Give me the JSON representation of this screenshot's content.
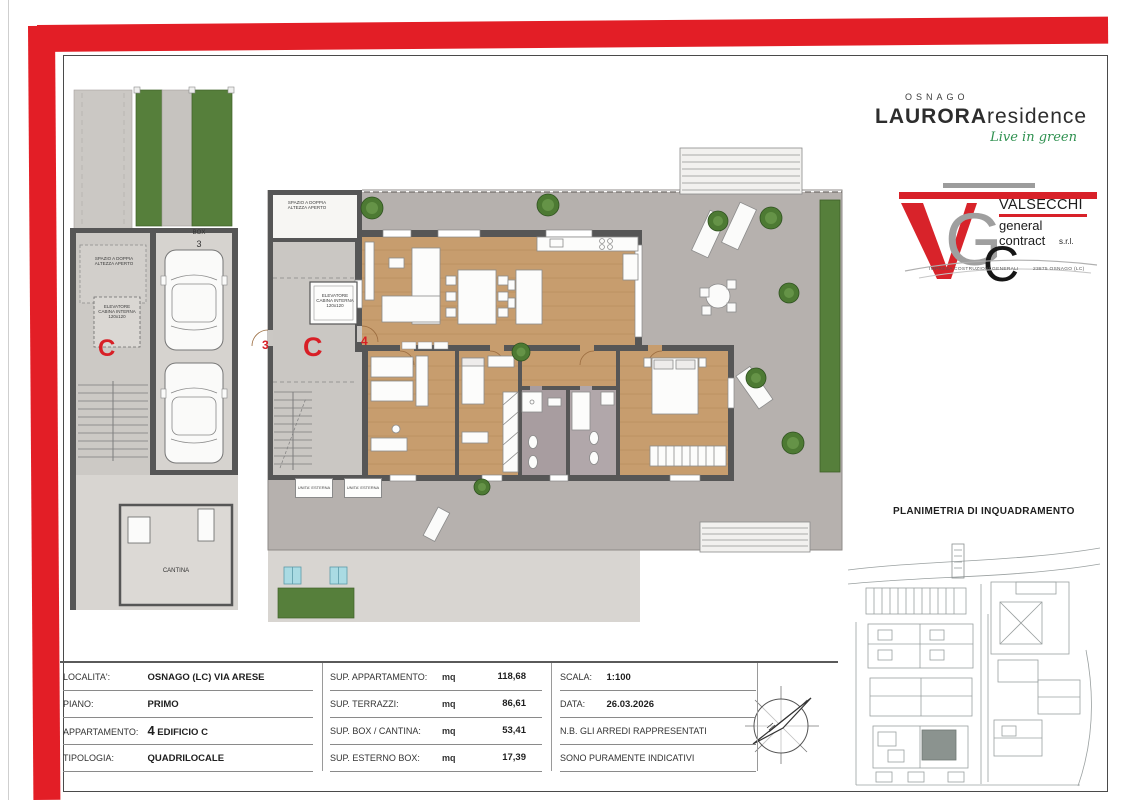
{
  "palette": {
    "accent_red": "#e31e26",
    "wall_gray": "#565656",
    "wood_floor": "#c79d6e",
    "terrace_gray": "#b6b1ae",
    "paving_gray": "#d8d5d1",
    "hedge_green": "#4d7a33",
    "bath_tile": "#a89da0",
    "skylight_blue": "#aadbe3"
  },
  "brand": {
    "city": "OSNAGO",
    "name": "LAURORA",
    "name_suffix": "residence",
    "tagline": "Live in green"
  },
  "contractor": {
    "name": "VALSECCHI",
    "line2": "general",
    "line3": "contract",
    "suffix": "s.r.l.",
    "footer_left": "IMPRESA COSTRUZIONI GENERALI",
    "footer_right": "23875 OSNAGO (LC)"
  },
  "left_plan": {
    "box_label": "BOX",
    "box_number": "3",
    "void_label": "SPAZIO A DOPPIA ALTEZZA APERTO",
    "elevator_label": "ELEVATORE CABINA INTERNA 120x120",
    "core_letter": "C",
    "cantina_label": "CANTINA"
  },
  "main_plan": {
    "void_label": "SPAZIO A DOPPIA ALTEZZA APERTO",
    "elevator_label": "ELEVATORE CABINA INTERNA 120x120",
    "core_letter": "C",
    "door_left": "3",
    "door_right": "4",
    "ext_unit_1": "UNITA' ESTERNA",
    "ext_unit_2": "UNITA' ESTERNA"
  },
  "inset": {
    "title": "PLANIMETRIA DI INQUADRAMENTO"
  },
  "info": {
    "left": [
      {
        "label": "LOCALITA':",
        "value_num": "",
        "value": "OSNAGO (LC) VIA ARESE"
      },
      {
        "label": "PIANO:",
        "value_num": "",
        "value": "PRIMO"
      },
      {
        "label": "APPARTAMENTO:",
        "value_num": "4",
        "value": "EDIFICIO C"
      },
      {
        "label": "TIPOLOGIA:",
        "value_num": "",
        "value": "QUADRILOCALE"
      }
    ],
    "center": [
      {
        "label": "SUP. APPARTAMENTO:",
        "unit": "mq",
        "value": "118,68"
      },
      {
        "label": "SUP. TERRAZZI:",
        "unit": "mq",
        "value": "86,61"
      },
      {
        "label": "SUP. BOX / CANTINA:",
        "unit": "mq",
        "value": "53,41"
      },
      {
        "label": "SUP. ESTERNO BOX:",
        "unit": "mq",
        "value": "17,39"
      }
    ],
    "right": {
      "scala_label": "SCALA:",
      "scala_value": "1:100",
      "data_label": "DATA:",
      "data_value": "26.03.2026",
      "note_line1": "N.B. GLI ARREDI RAPPRESENTATI",
      "note_line2": "SONO PURAMENTE INDICATIVI"
    }
  }
}
